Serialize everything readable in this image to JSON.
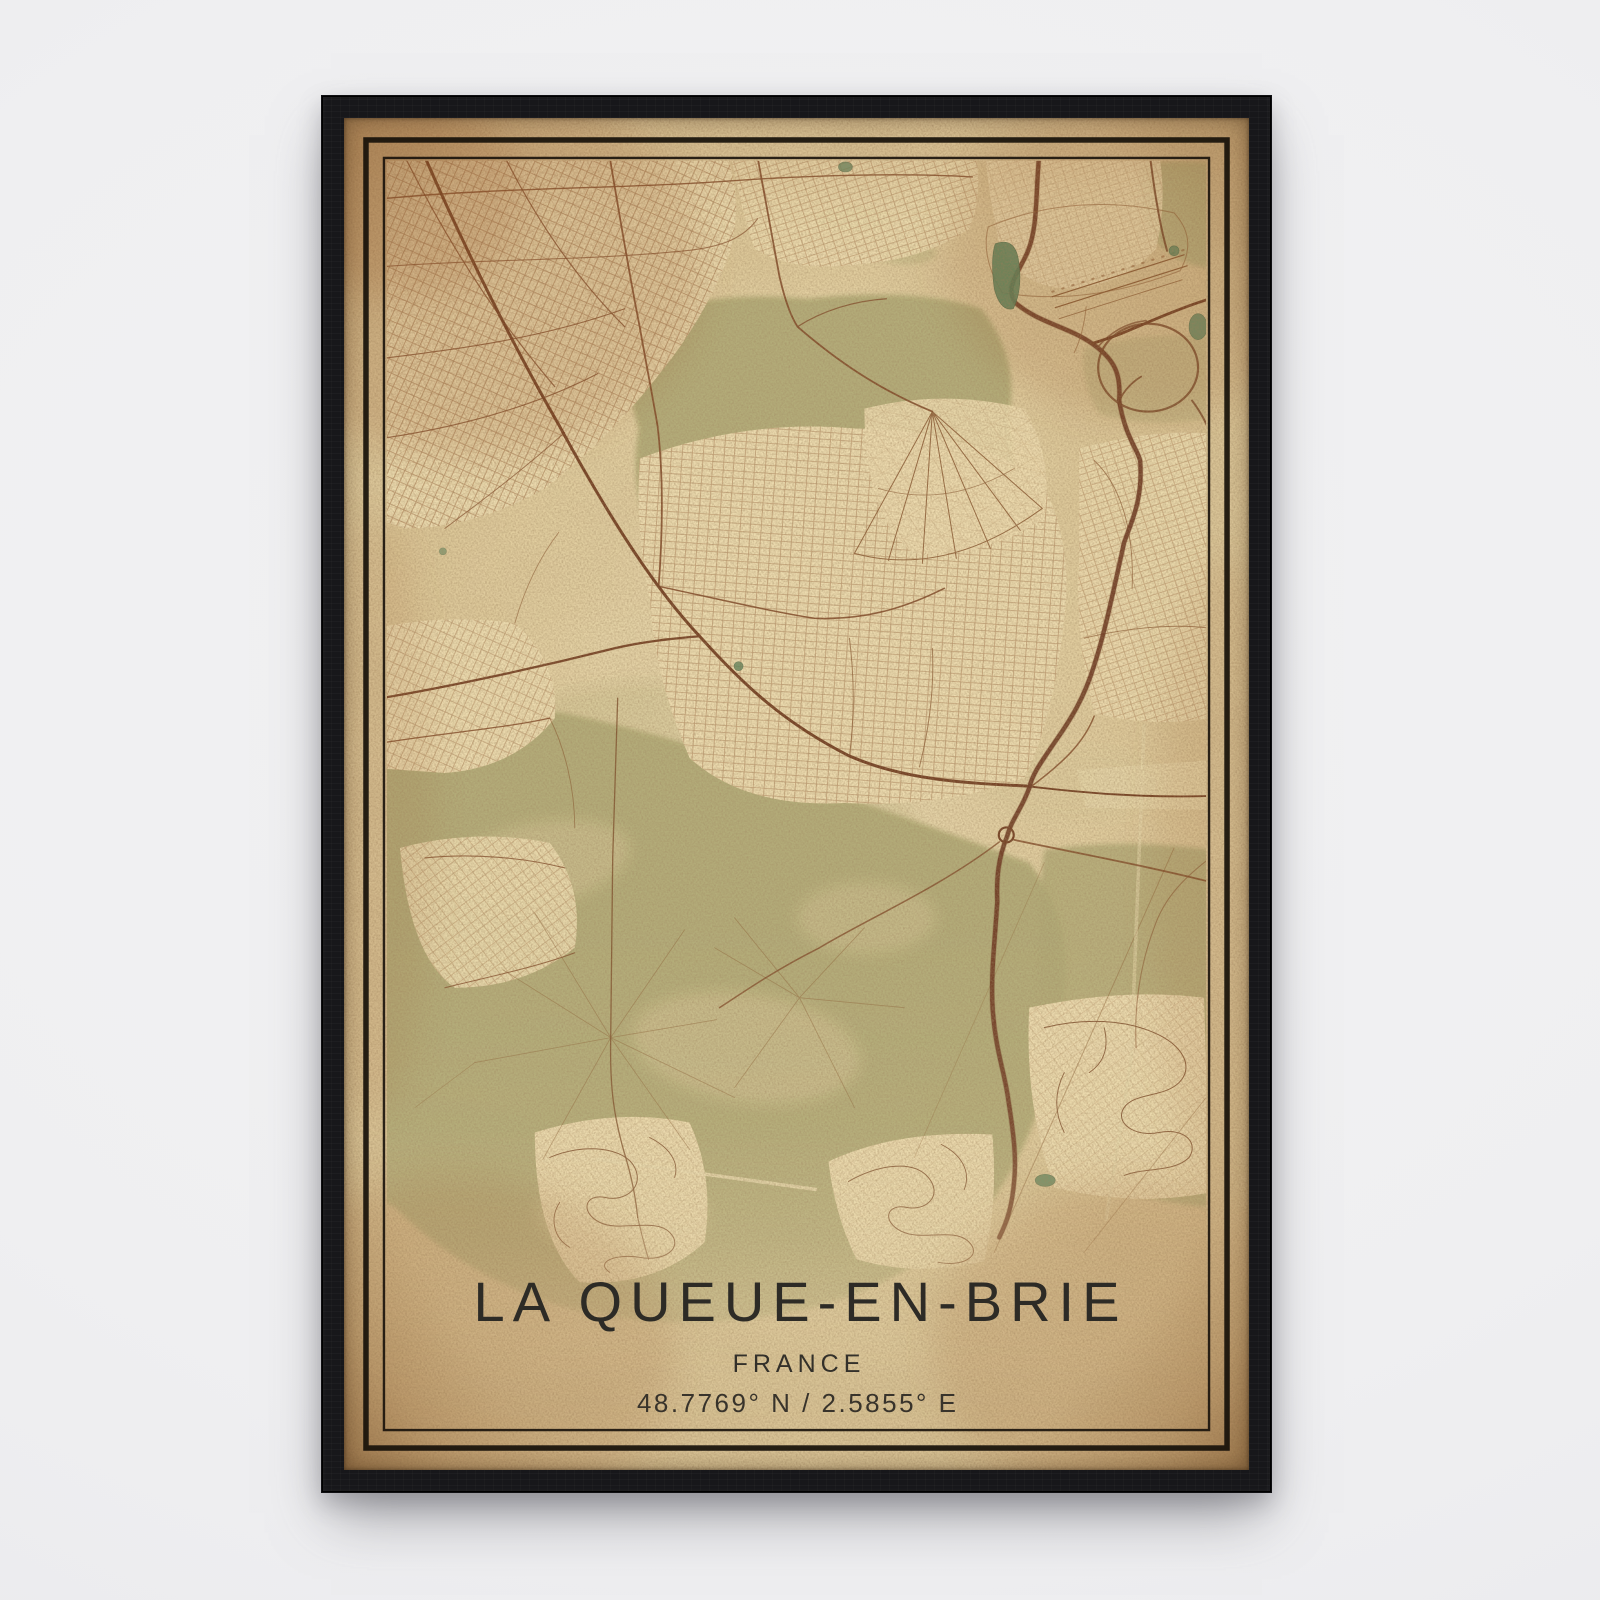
{
  "poster": {
    "title": "LA QUEUE-EN-BRIE",
    "country": "FRANCE",
    "coordinates": "48.7769° N / 2.5855° E",
    "style": "vintage sepia street-map print with double black keyline border"
  },
  "frame": {
    "material": "black wood frame",
    "color": "#17171a"
  },
  "background": {
    "color": "#f0f0f2"
  },
  "map": {
    "type": "street map, aged paper look",
    "place": "La Queue-en-Brie and surroundings",
    "visible_features": [
      "dense street grid in the north-west",
      "large forest patch in the upper centre",
      "motorway with loop interchange and roundabout along the east side",
      "airfield runways in the top-right",
      "big forest with star-shaped crossroads in the south-west",
      "two curvy housing estates near the bottom",
      "small teal ponds"
    ]
  },
  "palette": {
    "paper_light": "#ecdfb9",
    "paper_mid": "#dcc89c",
    "paper_edge": "#c5a474",
    "forest_green": "#b2ae7b",
    "urban_cream": "#eedfb5",
    "road_brown": "#7c4527",
    "highway_brown": "#6a3722",
    "water_teal": "#55815c",
    "ink_text": "#2d2b26",
    "keyline_ink": "#17110a"
  }
}
